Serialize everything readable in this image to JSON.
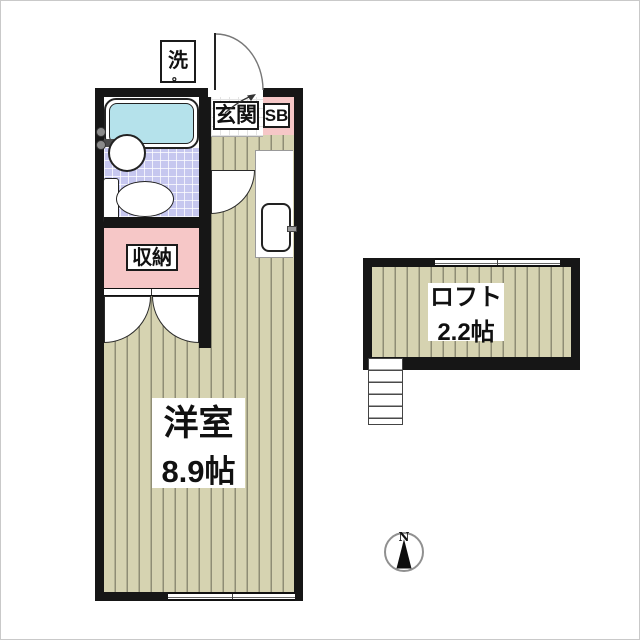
{
  "floorplan": {
    "rooms": {
      "washer": "洗",
      "washer_mark": "。",
      "entrance": "玄関",
      "shoe_box": "SB",
      "closet": "収納",
      "main_room": "洋室",
      "main_room_size": "8.9帖",
      "loft": "ロフト",
      "loft_size": "2.2帖"
    },
    "compass": {
      "north": "N"
    },
    "colors": {
      "wall": "#161616",
      "floor_beige": "#d6d3b1",
      "floor_stripe": "#8f8d75",
      "bath_tile_lavender": "#c6c7ef",
      "bathtub_cyan": "#b5e2eb",
      "room_pink": "#f6c7c7",
      "compass_ring_gray": "#909090"
    }
  }
}
